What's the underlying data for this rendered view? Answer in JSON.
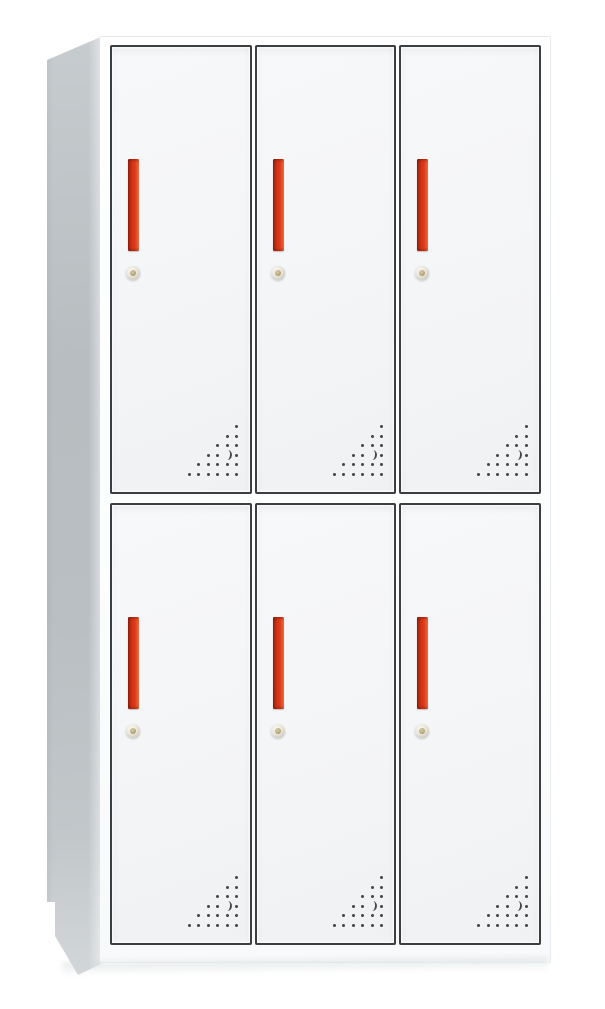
{
  "image": {
    "kind": "product photograph",
    "subject": "White 6-door steel locker cabinet with red vertical handles, round cam locks and perforated corner vents, shown in three-quarter view on a plain white background",
    "background": "plain white"
  },
  "cabinet": {
    "rows": 2,
    "columns": 3,
    "door_count": 6,
    "doors": [
      {
        "id": "top-left"
      },
      {
        "id": "top-center"
      },
      {
        "id": "top-right"
      },
      {
        "id": "bottom-left"
      },
      {
        "id": "bottom-center"
      },
      {
        "id": "bottom-right"
      }
    ],
    "door_features": [
      "red vertical recessed pull handle",
      "round cam lock below handle",
      "triangular perforated vent grille in bottom-right corner"
    ]
  },
  "colors": {
    "background": "#ffffff",
    "cabinet_body": "#fcfdfd",
    "door_face": "#f4f5f7",
    "door_outline": "#3b3f42",
    "side_panel": "#b9bfc2",
    "handle_red": "#d93318",
    "handle_red_dark": "#8e1f0e",
    "handle_red_light": "#f07a4e",
    "lock_face": "#e9e5dc",
    "lock_center": "#b5a97f",
    "vent_dot": "#43474a"
  },
  "vent": {
    "rows": 6,
    "pitch": 9.5,
    "dot_size": 3,
    "crescent_row": 4,
    "crescent_col_from_right": 2
  }
}
